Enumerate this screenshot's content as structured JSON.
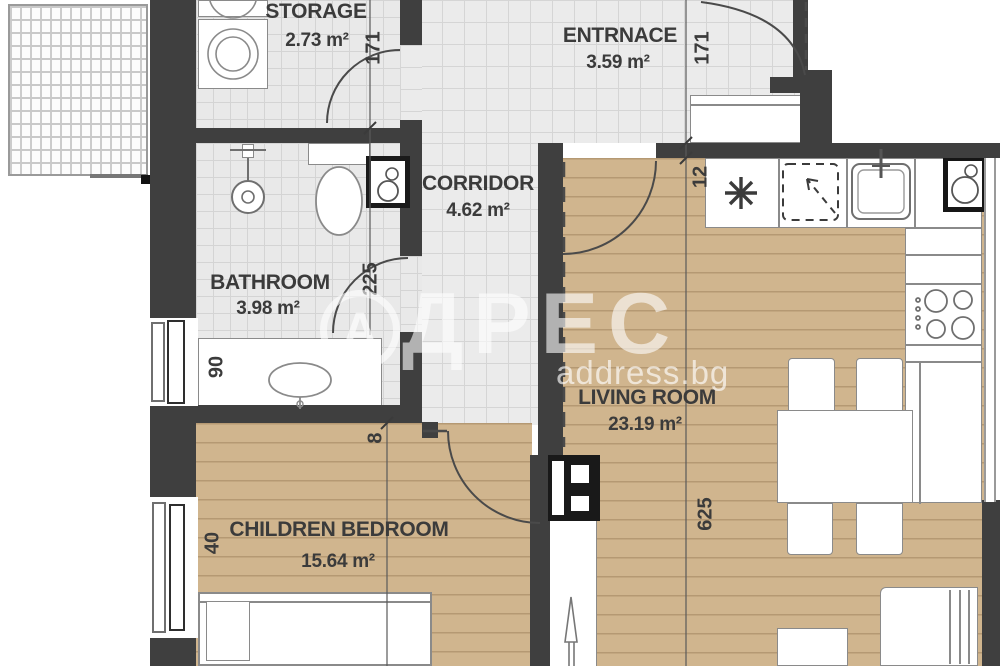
{
  "plan": {
    "rooms": {
      "storage": {
        "name": "STORAGE",
        "area": "2.73 m²"
      },
      "entrance": {
        "name": "ENTRNACE",
        "area": "3.59 m²"
      },
      "corridor": {
        "name": "CORRIDOR",
        "area": "4.62 m²"
      },
      "bathroom": {
        "name": "BATHROOM",
        "area": "3.98 m²"
      },
      "children_bedroom": {
        "name": "CHILDREN BEDROOM",
        "area": "15.64 m²"
      },
      "living_room": {
        "name": "LIVING ROOM",
        "area": "23.19 m²"
      }
    },
    "dimensions": {
      "storage_door": "171",
      "entrance_door": "171",
      "kitchen_offset": "12",
      "bathroom_door": "225",
      "bathroom_window": "90",
      "bedroom_window": "40",
      "living_length": "625",
      "wall_offset": "8"
    },
    "watermark": {
      "logo_letter": "А",
      "brand_rest": "ДРЕС",
      "site": "address.bg"
    },
    "colors": {
      "wall": "#3f3f3f",
      "wood_floor": "#d0b58e",
      "tile_floor": "#ebebeb",
      "label": "#3b3b3b"
    }
  }
}
